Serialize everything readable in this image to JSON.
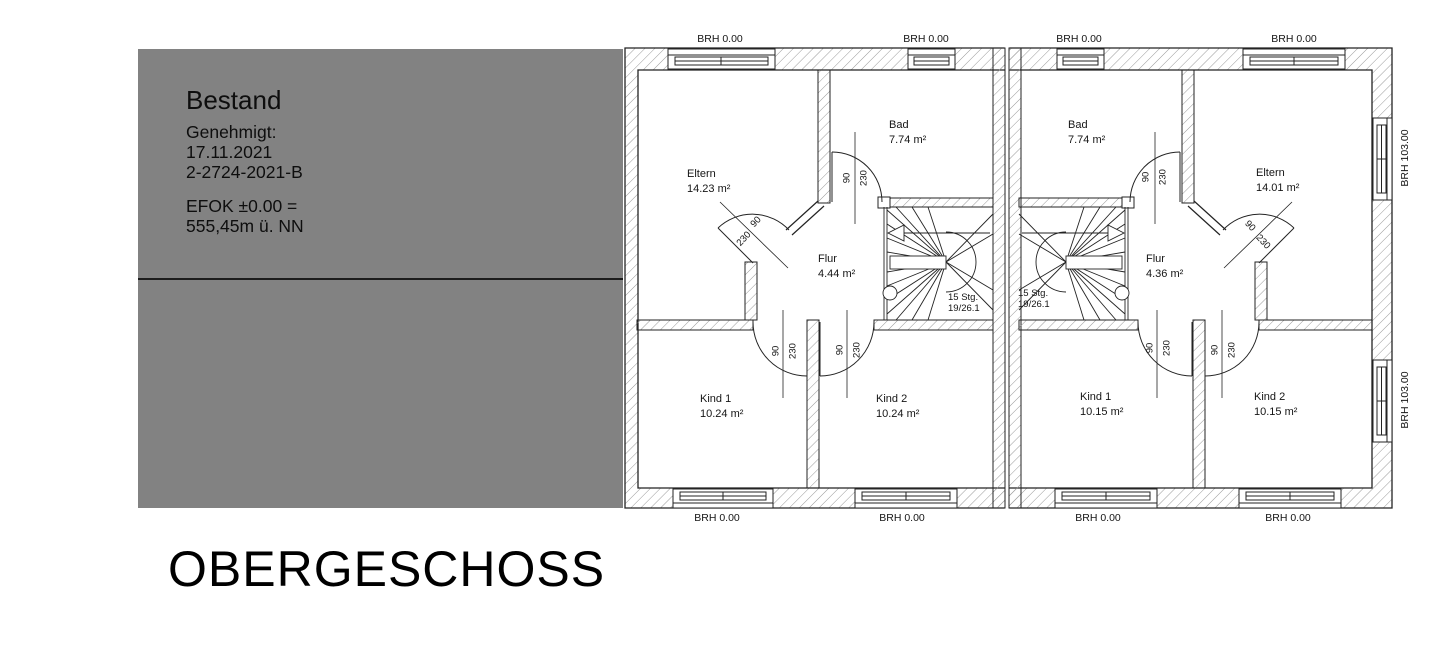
{
  "colors": {
    "panel_gray": "#828282",
    "line": "#232323",
    "hatch": "#9a9a9a",
    "text": "#151515"
  },
  "title_block": {
    "status": "Bestand",
    "approved_label": "Genehmigt:",
    "approved_date": "17.11.2021",
    "file_number": "2-2724-2021-B",
    "datum_line1": "EFOK ±0.00 =",
    "datum_line2": "555,45m ü. NN"
  },
  "floor_label": "OBERGESCHOSS",
  "plan": {
    "units": [
      {
        "id": "left",
        "rooms": {
          "eltern": {
            "name": "Eltern",
            "area": "14.23 m²"
          },
          "bad": {
            "name": "Bad",
            "area": "7.74 m²"
          },
          "flur": {
            "name": "Flur",
            "area": "4.44 m²"
          },
          "kind1": {
            "name": "Kind 1",
            "area": "10.24 m²"
          },
          "kind2": {
            "name": "Kind 2",
            "area": "10.24 m²"
          }
        },
        "stair": {
          "line1": "15 Stg.",
          "line2": "19/26.1"
        }
      },
      {
        "id": "right",
        "rooms": {
          "bad": {
            "name": "Bad",
            "area": "7.74 m²"
          },
          "eltern": {
            "name": "Eltern",
            "area": "14.01 m²"
          },
          "flur": {
            "name": "Flur",
            "area": "4.36 m²"
          },
          "kind1": {
            "name": "Kind 1",
            "area": "10.15 m²"
          },
          "kind2": {
            "name": "Kind 2",
            "area": "10.15 m²"
          }
        },
        "stair": {
          "line1": "15 Stg.",
          "line2": "19/26.1"
        }
      }
    ],
    "sills": {
      "top": [
        "BRH 0.00",
        "BRH 0.00",
        "BRH 0.00",
        "BRH 0.00"
      ],
      "bottom": [
        "BRH 0.00",
        "BRH 0.00",
        "BRH 0.00",
        "BRH 0.00"
      ],
      "side": [
        "BRH 103.00",
        "BRH 103.00"
      ]
    },
    "door": {
      "width": "90",
      "height": "230"
    }
  }
}
